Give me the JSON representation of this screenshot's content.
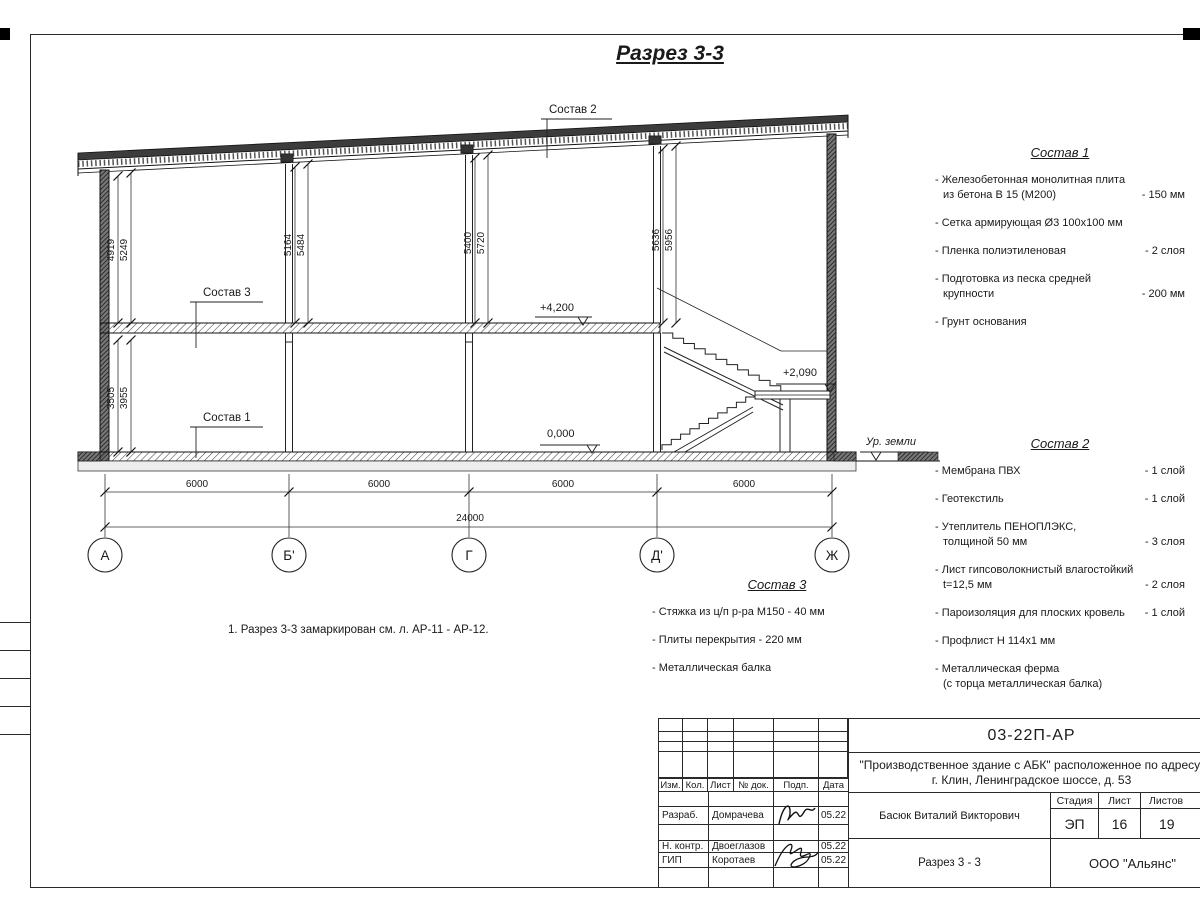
{
  "page": {
    "title": "Разрез 3-3",
    "note": "1. Разрез 3-3 замаркирован см. л. АР-11 - АР-12."
  },
  "drawing": {
    "callouts": {
      "sostav1": "Состав 1",
      "sostav2": "Состав 2",
      "sostav3": "Состав 3"
    },
    "elevations": {
      "roof_floor": "+4,200",
      "landing": "+2,090",
      "zero": "0,000",
      "ground": "Ур. земли"
    },
    "vdims": {
      "a1": "4919",
      "a2": "5249",
      "b1": "5164",
      "b2": "5484",
      "c1": "5400",
      "c2": "5720",
      "d1": "5636",
      "d2": "5956",
      "low1": "3505",
      "low2": "3955"
    },
    "hdims": {
      "s1": "6000",
      "s2": "6000",
      "s3": "6000",
      "s4": "6000",
      "total": "24000"
    },
    "axes": {
      "a": "А",
      "b": "Б'",
      "c": "Г",
      "d": "Д'",
      "e": "Ж"
    }
  },
  "lists": {
    "sostav1": {
      "title": "Состав 1",
      "lines": [
        {
          "t": "- Железобетонная  монолитная плита",
          "v": ""
        },
        {
          "t": "из бетона В 15 (М200)",
          "v": "- 150 мм"
        },
        {
          "t": "- Сетка армирующая Ø3 100х100 мм",
          "v": ""
        },
        {
          "t": "- Пленка полиэтиленовая",
          "v": "- 2 слоя"
        },
        {
          "t": "- Подготовка из песка средней",
          "v": ""
        },
        {
          "t": "крупности",
          "v": "- 200 мм"
        },
        {
          "t": "- Грунт основания",
          "v": ""
        }
      ]
    },
    "sostav2": {
      "title": "Состав 2",
      "lines": [
        {
          "t": "- Мембрана ПВХ",
          "v": "- 1 слой"
        },
        {
          "t": "- Геотекстиль",
          "v": "- 1 слой"
        },
        {
          "t": "- Утеплитель ПЕНОПЛЭКС,",
          "v": ""
        },
        {
          "t": "толщиной 50 мм",
          "v": "- 3 слоя"
        },
        {
          "t": "- Лист гипсоволокнистый влагостойкий",
          "v": ""
        },
        {
          "t": "t=12,5 мм",
          "v": "- 2 слоя"
        },
        {
          "t": "- Пароизоляция для плоских кровель",
          "v": "- 1 слой"
        },
        {
          "t": "- Профлист Н 114х1 мм",
          "v": ""
        },
        {
          "t": "- Металлическая ферма",
          "v": ""
        },
        {
          "t": "(с торца металлическая балка)",
          "v": ""
        }
      ]
    },
    "sostav3": {
      "title": "Состав 3",
      "lines": [
        {
          "t": "- Стяжка из ц/п р-ра М150 - 40 мм",
          "v": ""
        },
        {
          "t": "- Плиты перекрытия - 220 мм",
          "v": ""
        },
        {
          "t": "- Металлическая балка",
          "v": ""
        }
      ]
    }
  },
  "titleblock": {
    "doc_number": "03-22П-АР",
    "project_line1": "\"Производственное здание с АБК\" расположенное по адресу:",
    "project_line2": "г. Клин, Ленинградское шоссе, д. 53",
    "cols": {
      "izm": "Изм.",
      "kol": "Кол.",
      "list": "Лист",
      "doc": "№ док.",
      "podp": "Подп.",
      "data": "Дата"
    },
    "rows": {
      "r1": {
        "role": "Разраб.",
        "name": "Домрачева",
        "date": "05.22"
      },
      "r2": {
        "role": "Н. контр.",
        "name": "Двоеглазов",
        "date": "05.22"
      },
      "r3": {
        "role": "ГИП",
        "name": "Коротаев",
        "date": "05.22"
      }
    },
    "approver": "Басюк Виталий Викторович",
    "stage_label": "Стадия",
    "sheet_label": "Лист",
    "sheets_label": "Листов",
    "stage": "ЭП",
    "sheet": "16",
    "sheets": "19",
    "drawing_name": "Разрез 3 - 3",
    "company": "ООО \"Альянс\""
  }
}
